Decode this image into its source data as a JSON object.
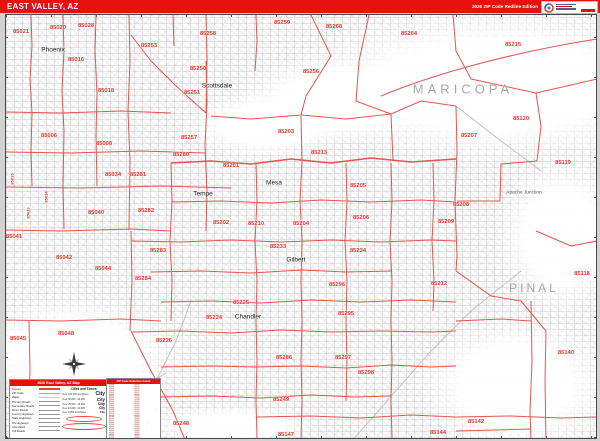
{
  "title_bar": {
    "title": "EAST VALLEY, AZ",
    "edition": "2020 ZIP Code Redline Edition"
  },
  "colors": {
    "bar_red": "#e8100c",
    "zip_boundary": "#e4564e",
    "zip_label": "#e2362d",
    "county_label": "#a8a8a8",
    "city_label": "#191919"
  },
  "map": {
    "county_labels": [
      {
        "text": "MARICOPA",
        "x": 462,
        "y": 88
      },
      {
        "text": "PINAL",
        "x": 533,
        "y": 287,
        "cls": "pinal"
      }
    ],
    "city_labels": [
      {
        "text": "Phoenix",
        "x": 52,
        "y": 49
      },
      {
        "text": "Scottsdale",
        "x": 216,
        "y": 85
      },
      {
        "text": "Tempe",
        "x": 202,
        "y": 193
      },
      {
        "text": "Mesa",
        "x": 273,
        "y": 182
      },
      {
        "text": "Gilbert",
        "x": 295,
        "y": 259
      },
      {
        "text": "Chandler",
        "x": 247,
        "y": 316
      },
      {
        "text": "Apache Junction",
        "x": 523,
        "y": 192,
        "cls": "small"
      }
    ],
    "zip_labels": [
      {
        "text": "85021",
        "x": 20,
        "y": 31
      },
      {
        "text": "85020",
        "x": 57,
        "y": 27
      },
      {
        "text": "85028",
        "x": 85,
        "y": 25
      },
      {
        "text": "85253",
        "x": 148,
        "y": 45
      },
      {
        "text": "85258",
        "x": 207,
        "y": 33
      },
      {
        "text": "85259",
        "x": 281,
        "y": 22
      },
      {
        "text": "85268",
        "x": 333,
        "y": 26
      },
      {
        "text": "85264",
        "x": 408,
        "y": 33
      },
      {
        "text": "85215",
        "x": 512,
        "y": 44
      },
      {
        "text": "85250",
        "x": 197,
        "y": 68
      },
      {
        "text": "85251",
        "x": 191,
        "y": 92
      },
      {
        "text": "85256",
        "x": 310,
        "y": 71
      },
      {
        "text": "85016",
        "x": 75,
        "y": 59
      },
      {
        "text": "85018",
        "x": 105,
        "y": 90
      },
      {
        "text": "85006",
        "x": 48,
        "y": 135
      },
      {
        "text": "85008",
        "x": 103,
        "y": 143
      },
      {
        "text": "85257",
        "x": 188,
        "y": 137
      },
      {
        "text": "85280",
        "x": 180,
        "y": 154
      },
      {
        "text": "85034",
        "x": 112,
        "y": 174
      },
      {
        "text": "85281",
        "x": 137,
        "y": 174
      },
      {
        "text": "85201",
        "x": 230,
        "y": 165
      },
      {
        "text": "85203",
        "x": 285,
        "y": 131
      },
      {
        "text": "85213",
        "x": 318,
        "y": 152
      },
      {
        "text": "85205",
        "x": 357,
        "y": 185
      },
      {
        "text": "85206",
        "x": 360,
        "y": 217
      },
      {
        "text": "85207",
        "x": 468,
        "y": 135
      },
      {
        "text": "85120",
        "x": 520,
        "y": 118
      },
      {
        "text": "85119",
        "x": 562,
        "y": 162
      },
      {
        "text": "85118",
        "x": 581,
        "y": 273
      },
      {
        "text": "85202",
        "x": 220,
        "y": 222
      },
      {
        "text": "85210",
        "x": 255,
        "y": 223
      },
      {
        "text": "85204",
        "x": 300,
        "y": 223
      },
      {
        "text": "85233",
        "x": 277,
        "y": 246
      },
      {
        "text": "85234",
        "x": 357,
        "y": 250
      },
      {
        "text": "85296",
        "x": 336,
        "y": 284
      },
      {
        "text": "85295",
        "x": 345,
        "y": 313
      },
      {
        "text": "85297",
        "x": 342,
        "y": 357
      },
      {
        "text": "85298",
        "x": 365,
        "y": 372
      },
      {
        "text": "85286",
        "x": 283,
        "y": 357
      },
      {
        "text": "85225",
        "x": 240,
        "y": 302
      },
      {
        "text": "85224",
        "x": 213,
        "y": 317
      },
      {
        "text": "85226",
        "x": 163,
        "y": 340
      },
      {
        "text": "85040",
        "x": 95,
        "y": 212
      },
      {
        "text": "85282",
        "x": 145,
        "y": 210
      },
      {
        "text": "85041",
        "x": 13,
        "y": 236
      },
      {
        "text": "85042",
        "x": 63,
        "y": 257
      },
      {
        "text": "85044",
        "x": 102,
        "y": 268
      },
      {
        "text": "85283",
        "x": 157,
        "y": 250
      },
      {
        "text": "85284",
        "x": 142,
        "y": 278
      },
      {
        "text": "85045",
        "x": 17,
        "y": 338
      },
      {
        "text": "85048",
        "x": 65,
        "y": 333
      },
      {
        "text": "85248",
        "x": 180,
        "y": 423
      },
      {
        "text": "85249",
        "x": 280,
        "y": 399
      },
      {
        "text": "85147",
        "x": 285,
        "y": 434
      },
      {
        "text": "85212",
        "x": 438,
        "y": 283
      },
      {
        "text": "85208",
        "x": 460,
        "y": 204
      },
      {
        "text": "85209",
        "x": 445,
        "y": 221
      },
      {
        "text": "85142",
        "x": 475,
        "y": 421
      },
      {
        "text": "85144",
        "x": 437,
        "y": 432
      },
      {
        "text": "85140",
        "x": 565,
        "y": 352
      }
    ],
    "vertical_zip_labels": [
      {
        "text": "85015",
        "x": 11,
        "y": 178
      },
      {
        "text": "85013",
        "x": 27,
        "y": 212
      },
      {
        "text": "85014",
        "x": 45,
        "y": 196
      }
    ]
  },
  "legend": {
    "title": "2020 East Valley, AZ Map",
    "left_rows": [
      {
        "label": "County",
        "swatch": "sw-county"
      },
      {
        "label": "ZIP Code",
        "swatch": "sw-zip"
      },
      {
        "label": "Water",
        "swatch": "sw-water"
      },
      {
        "label": "Primary Roads",
        "swatch": ""
      },
      {
        "label": "Secondary Roads",
        "swatch": ""
      },
      {
        "label": "Minor Roads",
        "swatch": ""
      },
      {
        "label": "County Highways",
        "swatch": ""
      },
      {
        "label": "State Highways",
        "swatch": ""
      },
      {
        "label": "US Highways",
        "swatch": ""
      },
      {
        "label": "Interstates",
        "swatch": ""
      },
      {
        "label": "Toll Roads",
        "swatch": ""
      }
    ],
    "cities_header": "Cities and Towns",
    "city_rows": [
      {
        "range": "Over 100,000 and Above",
        "sample": "City"
      },
      {
        "range": "Over 50,000 - 99,999",
        "sample": "City"
      },
      {
        "range": "Over 25,000 - 49,999",
        "sample": "City"
      },
      {
        "range": "Over 10,000 - 24,999",
        "sample": "City"
      },
      {
        "range": "Over 9,999 and Below",
        "sample": "City"
      }
    ]
  },
  "guide": {
    "title": "ZIP Code Selection Guide",
    "rows": [
      {
        "zip": "85006",
        "name": "Phoenix"
      },
      {
        "zip": "85008",
        "name": "Phoenix"
      },
      {
        "zip": "85016",
        "name": "Phoenix"
      },
      {
        "zip": "85018",
        "name": "Phoenix"
      },
      {
        "zip": "85020",
        "name": "Phoenix"
      },
      {
        "zip": "85021",
        "name": "Phoenix"
      },
      {
        "zip": "85028",
        "name": "Phoenix"
      },
      {
        "zip": "85034",
        "name": "Phoenix"
      },
      {
        "zip": "85040",
        "name": "Phoenix"
      },
      {
        "zip": "85041",
        "name": "Phoenix"
      },
      {
        "zip": "85042",
        "name": "Phoenix"
      },
      {
        "zip": "85044",
        "name": "Phoenix"
      },
      {
        "zip": "85045",
        "name": "Phoenix"
      },
      {
        "zip": "85048",
        "name": "Phoenix"
      },
      {
        "zip": "85118",
        "name": "Gold Canyon"
      },
      {
        "zip": "85119",
        "name": "Apache Junction"
      },
      {
        "zip": "85120",
        "name": "Apache Junction"
      },
      {
        "zip": "85140",
        "name": "San Tan Valley"
      },
      {
        "zip": "85142",
        "name": "Queen Creek"
      },
      {
        "zip": "85147",
        "name": "Sacaton"
      },
      {
        "zip": "85201",
        "name": "Mesa"
      },
      {
        "zip": "85202",
        "name": "Mesa"
      },
      {
        "zip": "85203",
        "name": "Mesa"
      },
      {
        "zip": "85204",
        "name": "Mesa"
      },
      {
        "zip": "85205",
        "name": "Mesa"
      },
      {
        "zip": "85206",
        "name": "Mesa"
      },
      {
        "zip": "85207",
        "name": "Mesa"
      },
      {
        "zip": "85208",
        "name": "Mesa"
      },
      {
        "zip": "85209",
        "name": "Mesa"
      },
      {
        "zip": "85210",
        "name": "Mesa"
      },
      {
        "zip": "85212",
        "name": "Mesa"
      },
      {
        "zip": "85213",
        "name": "Mesa"
      },
      {
        "zip": "85215",
        "name": "Mesa"
      },
      {
        "zip": "85224",
        "name": "Chandler"
      },
      {
        "zip": "85225",
        "name": "Chandler"
      },
      {
        "zip": "85226",
        "name": "Chandler"
      },
      {
        "zip": "85233",
        "name": "Gilbert"
      },
      {
        "zip": "85234",
        "name": "Gilbert"
      },
      {
        "zip": "85248",
        "name": "Chandler"
      },
      {
        "zip": "85249",
        "name": "Chandler"
      },
      {
        "zip": "85250",
        "name": "Scottsdale"
      },
      {
        "zip": "85251",
        "name": "Scottsdale"
      },
      {
        "zip": "85253",
        "name": "Paradise Valley"
      },
      {
        "zip": "85256",
        "name": "Scottsdale"
      },
      {
        "zip": "85257",
        "name": "Scottsdale"
      },
      {
        "zip": "85258",
        "name": "Scottsdale"
      },
      {
        "zip": "85259",
        "name": "Scottsdale"
      },
      {
        "zip": "85264",
        "name": "Fort McDowell"
      },
      {
        "zip": "85268",
        "name": "Fountain Hills"
      },
      {
        "zip": "85280",
        "name": "Tempe"
      },
      {
        "zip": "85281",
        "name": "Tempe"
      },
      {
        "zip": "85282",
        "name": "Tempe"
      },
      {
        "zip": "85283",
        "name": "Tempe"
      },
      {
        "zip": "85284",
        "name": "Tempe"
      },
      {
        "zip": "85286",
        "name": "Chandler"
      },
      {
        "zip": "85295",
        "name": "Gilbert"
      },
      {
        "zip": "85296",
        "name": "Gilbert"
      },
      {
        "zip": "85297",
        "name": "Gilbert"
      },
      {
        "zip": "85298",
        "name": "Gilbert"
      }
    ]
  }
}
